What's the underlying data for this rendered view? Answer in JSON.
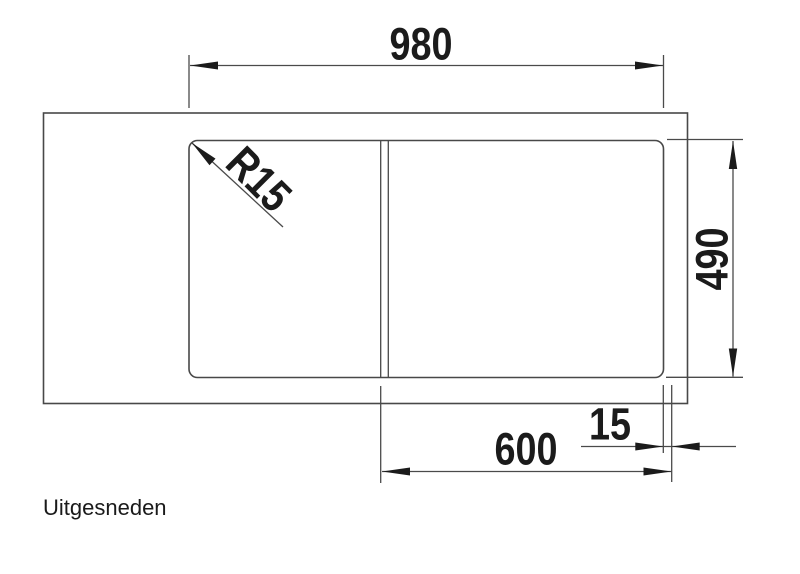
{
  "drawing": {
    "caption": "Uitgesneden",
    "dimensions": {
      "total_width": "980",
      "depth": "490",
      "bowl_width": "600",
      "rim_offset": "15",
      "corner_radius": "R15"
    }
  }
}
